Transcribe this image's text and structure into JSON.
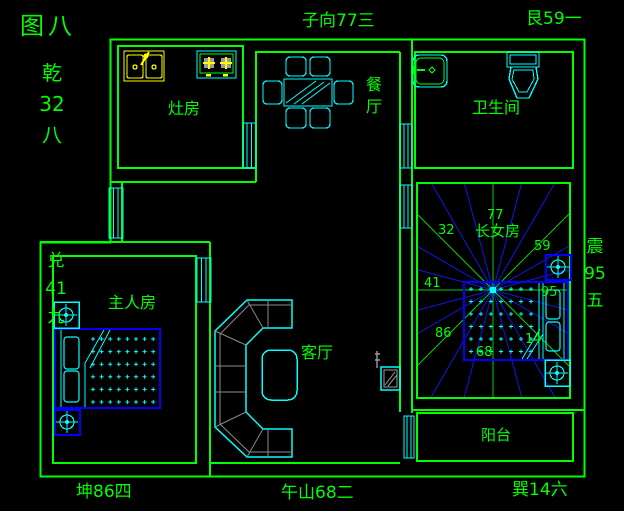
{
  "figure_title": "图八",
  "border_labels": {
    "top_center": "子向77三",
    "top_right": "艮59一",
    "bottom_left": "坤86四",
    "bottom_center": "午山68二",
    "bottom_right": "巽14六",
    "left_top_stack": [
      "乾",
      "32",
      "八"
    ],
    "left_mid_stack": [
      "兑",
      "41",
      "九"
    ],
    "right_stack": [
      "震",
      "95",
      "五"
    ]
  },
  "rooms": {
    "kitchen": "灶房",
    "dining": [
      "餐",
      "厅"
    ],
    "bathroom": "卫生间",
    "master_bedroom": "主人房",
    "living_room": "客厅",
    "daughter_room": "长女房",
    "balcony": "阳台"
  },
  "star_numbers": {
    "nw": "32",
    "n": "77",
    "ne": "59",
    "w": "41",
    "e": "95",
    "sw": "86",
    "s": "68",
    "se": "14"
  },
  "colors": {
    "background": "#000000",
    "wall": "#00ff00",
    "furniture": "#00ffff",
    "bed": "#0000ff",
    "sink": "#ffff00",
    "detail_gray": "#9c9c9c",
    "ray_blue": "#1515e6",
    "ray_green": "#00d400"
  },
  "compass": {
    "center_x": 493,
    "center_y": 290,
    "ray_count": 24,
    "ray_step_deg": 15
  }
}
